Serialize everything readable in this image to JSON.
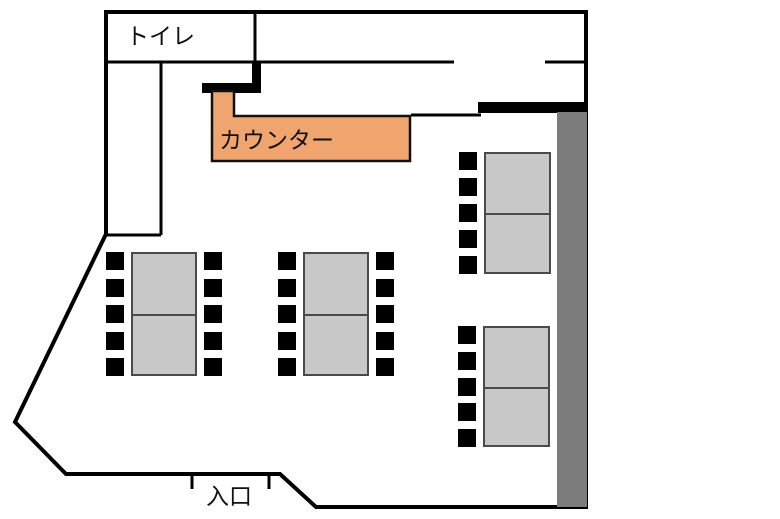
{
  "plan": {
    "labels": {
      "toilet": "トイレ",
      "counter": "カウンター",
      "entrance": "入口"
    },
    "colors": {
      "background": "#ffffff",
      "wall": "#000000",
      "gray_wall": "#7c7c7c",
      "counter_fill": "#f0a46e",
      "counter_border": "#111111",
      "table_fill": "#c8c8c8",
      "table_border": "#4a4a4a",
      "chair": "#000000"
    },
    "tables": [
      {
        "id": "table-1",
        "x": 131,
        "y": 252,
        "w": 66,
        "h": 124,
        "chairs_left": 5,
        "chairs_right": 5
      },
      {
        "id": "table-2",
        "x": 303,
        "y": 252,
        "w": 66,
        "h": 124,
        "chairs_left": 5,
        "chairs_right": 5
      },
      {
        "id": "table-3",
        "x": 484,
        "y": 152,
        "w": 67,
        "h": 122,
        "chairs_left": 5,
        "chairs_right": 0
      },
      {
        "id": "table-4",
        "x": 483,
        "y": 326,
        "w": 67,
        "h": 121,
        "chairs_left": 5,
        "chairs_right": 0
      }
    ],
    "chair_size": 18
  }
}
